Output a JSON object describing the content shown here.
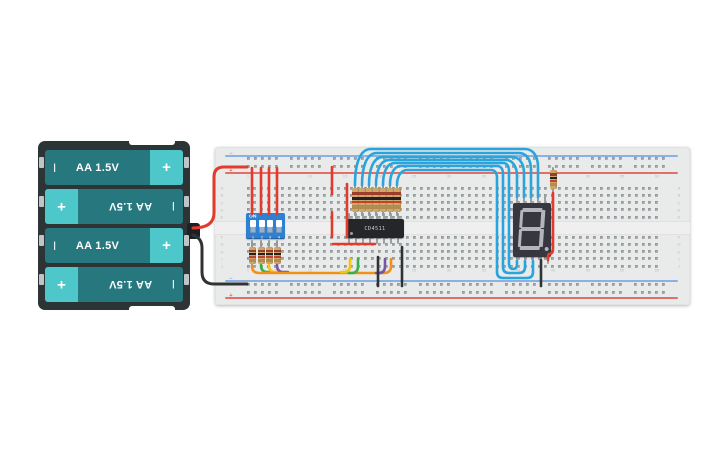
{
  "app": {
    "description": "circuit canvas with battery pack, breadboard, DIP switch, CD4511 decoder and 7-segment display"
  },
  "battery_pack": {
    "cells": [
      {
        "label": "AA 1.5V",
        "neg": "I",
        "pos": "+",
        "flipped": false
      },
      {
        "label": "AA 1.5V",
        "neg": "I",
        "pos": "+",
        "flipped": true
      },
      {
        "label": "AA 1.5V",
        "neg": "I",
        "pos": "+",
        "flipped": false
      },
      {
        "label": "AA 1.5V",
        "neg": "I",
        "pos": "+",
        "flipped": true
      }
    ],
    "colors": {
      "case": "#2d3436",
      "cell_body": "#26787e",
      "cell_cap": "#4ec7cb",
      "text": "#ffffff"
    }
  },
  "breadboard": {
    "column_labels": [
      "1",
      "5",
      "10",
      "15",
      "20",
      "25",
      "30",
      "35",
      "40",
      "45",
      "50",
      "55",
      "60"
    ],
    "column_numbers": [
      1,
      5,
      10,
      15,
      20,
      25,
      30,
      35,
      40,
      45,
      50,
      55,
      60
    ],
    "row_labels": [
      "A",
      "B",
      "C",
      "D",
      "E",
      "F",
      "G",
      "H",
      "I",
      "J"
    ],
    "rail_minus_glyph": "−",
    "rail_plus_glyph": "+",
    "colors": {
      "board": "#e9eaea",
      "hole": "#a6abad",
      "hole_shadow": "#82878a",
      "rail_blue": "#7aa6e2",
      "rail_red": "#e2584e",
      "label": "#bdbdbd"
    }
  },
  "dip_switch": {
    "on_label": "ON",
    "channel_labels": [
      "1",
      "2",
      "3",
      "4"
    ],
    "state": [
      true,
      true,
      true,
      true
    ],
    "colors": {
      "body": "#2f80d2",
      "slot": "#8fb3d6",
      "knob": "#ffffff",
      "text": "#ffffff"
    }
  },
  "ic": {
    "label": "CD4511",
    "colors": {
      "body": "#24262a",
      "text": "#c9ccd0"
    }
  },
  "display": {
    "shown_value": "8.",
    "segments": [
      "a",
      "b",
      "c",
      "d",
      "e",
      "f",
      "g",
      "dp"
    ],
    "colors": {
      "body": "#37383f",
      "segment_off": "#b4b5ba"
    }
  },
  "resistors": {
    "body_color": "#cfa76a",
    "band_colors": [
      "#9c3c2b",
      "#222222",
      "#bf4430",
      "#b08c4e"
    ],
    "groups": [
      {
        "name": "dip-pulldown-resistor",
        "count": 4
      },
      {
        "name": "segment-series-resistor",
        "count": 7
      },
      {
        "name": "decimal-point-resistor",
        "count": 1
      }
    ]
  },
  "wire_colors": {
    "red": "#e23b2e",
    "black": "#2f3336",
    "blue": "#29a4dc",
    "orange": "#f2901d",
    "green": "#3cae49",
    "yellow": "#f2c318",
    "purple": "#7a55a5"
  },
  "wires": [
    {
      "name": "battery-positive-wire",
      "color": "#e23b2e",
      "w": 3,
      "path": "M193,228 Q214,228 214,213 L214,177 Q214,167 224,167 L247,167"
    },
    {
      "name": "battery-negative-wire",
      "color": "#2f3336",
      "w": 3,
      "path": "M193,235 Q202,238 202,248 L202,272 Q202,284 214,284 L247,284"
    },
    {
      "name": "dip-power-wire-1",
      "color": "#e23b2e",
      "w": 2.6,
      "path": "M252,168 L252,214"
    },
    {
      "name": "dip-power-wire-2",
      "color": "#e23b2e",
      "w": 2.6,
      "path": "M261,168 L261,214"
    },
    {
      "name": "dip-power-wire-3",
      "color": "#e23b2e",
      "w": 2.6,
      "path": "M269,168 L269,214"
    },
    {
      "name": "dip-power-wire-4",
      "color": "#e23b2e",
      "w": 2.6,
      "path": "M277,168 L277,214"
    },
    {
      "name": "ic-power-wire-upper",
      "color": "#e23b2e",
      "w": 2.6,
      "path": "M332,167 L332,194"
    },
    {
      "name": "ic-power-wire-bridge",
      "color": "#e23b2e",
      "w": 2.6,
      "path": "M332,212 L332,237"
    },
    {
      "name": "ic-power-wire-col15",
      "color": "#e23b2e",
      "w": 2.6,
      "path": "M347,184 L347,237"
    },
    {
      "name": "ic-power-wire-rowg",
      "color": "#e23b2e",
      "w": 2.6,
      "path": "M333,244 L375,244"
    },
    {
      "name": "bcd-green-wire-left",
      "color": "#3cae49",
      "w": 2.6,
      "path": "M261,265 Q261,272 267,272 L272,272"
    },
    {
      "name": "bcd-yellow-wire-left",
      "color": "#f2c318",
      "w": 2.6,
      "path": "M269,265 Q269,272 275,272 L280,272"
    },
    {
      "name": "bcd-purple-wire-left",
      "color": "#7a55a5",
      "w": 2.6,
      "path": "M277,265 Q277,272 283,272 L288,272"
    },
    {
      "name": "bcd-orange-wire",
      "color": "#f2901d",
      "w": 2.6,
      "path": "M252,266 Q252,273 259,273 L384,273 Q391,273 391,266 L391,259"
    },
    {
      "name": "bcd-yellow-wire-right",
      "color": "#f2c318",
      "w": 2.6,
      "path": "M341,272 L344,272 Q350,272 350,266 L350,259"
    },
    {
      "name": "bcd-green-wire-right",
      "color": "#3cae49",
      "w": 2.6,
      "path": "M349,273 L352,273 Q358,273 358,266 L358,259"
    },
    {
      "name": "bcd-purple-wire-right",
      "color": "#7a55a5",
      "w": 2.6,
      "path": "M376,273 L379,273 Q385,273 385,266 L385,259"
    },
    {
      "name": "ground-wire-1",
      "color": "#2f3336",
      "w": 2.6,
      "path": "M378,257 L378,286"
    },
    {
      "name": "ground-wire-2",
      "color": "#2f3336",
      "w": 2.6,
      "path": "M402,247 L402,286"
    },
    {
      "name": "display-ground-wire",
      "color": "#2f3336",
      "w": 2.6,
      "path": "M541,260 L541,286"
    },
    {
      "name": "decimal-red-wire",
      "color": "#e23b2e",
      "w": 2.6,
      "path": "M553,193 L553,249 Q553,254 549,254 Q548,254 548,257 L548,260"
    },
    {
      "name": "segment-wire-1",
      "color": "#29a4dc",
      "w": 2.6,
      "path": "M355,185 C355,166 359,149 371,149 L525,149 C533,149 538,156 538,167 L538,197"
    },
    {
      "name": "segment-wire-2",
      "color": "#29a4dc",
      "w": 2.6,
      "path": "M362,185 C362,168 366,153 377,153 L519,153 C526,153 531,159 531,170 L531,197"
    },
    {
      "name": "segment-wire-3",
      "color": "#29a4dc",
      "w": 2.6,
      "path": "M369,185 C369,170 373,157 383,157 L512,157 C519,157 524,163 524,173 L524,197"
    },
    {
      "name": "segment-wire-4",
      "color": "#29a4dc",
      "w": 2.6,
      "path": "M376,185 C376,172 380,160 389,160 L506,160 C512,160 517,166 517,176 L517,197"
    },
    {
      "name": "segment-wire-5",
      "color": "#29a4dc",
      "w": 2.6,
      "path": "M383,185 C383,174 386,163 395,163 L503,163 C507,163 509,166 509,171 L509,263 Q509,269 513,269 Q517,269 517,264 L517,261"
    },
    {
      "name": "segment-wire-6",
      "color": "#29a4dc",
      "w": 2.6,
      "path": "M390,185 C390,176 393,166 401,166 L497,166 C501,166 503,169 503,174 L503,267 Q503,273 509,273 L519,273 Q525,273 525,267 L525,261"
    },
    {
      "name": "segment-wire-7",
      "color": "#29a4dc",
      "w": 2.6,
      "path": "M397,185 C397,178 400,170 407,170 L491,170 C495,170 497,173 497,178 L497,272 Q497,278 503,278 L527,278 Q533,278 533,272 L533,261"
    }
  ]
}
